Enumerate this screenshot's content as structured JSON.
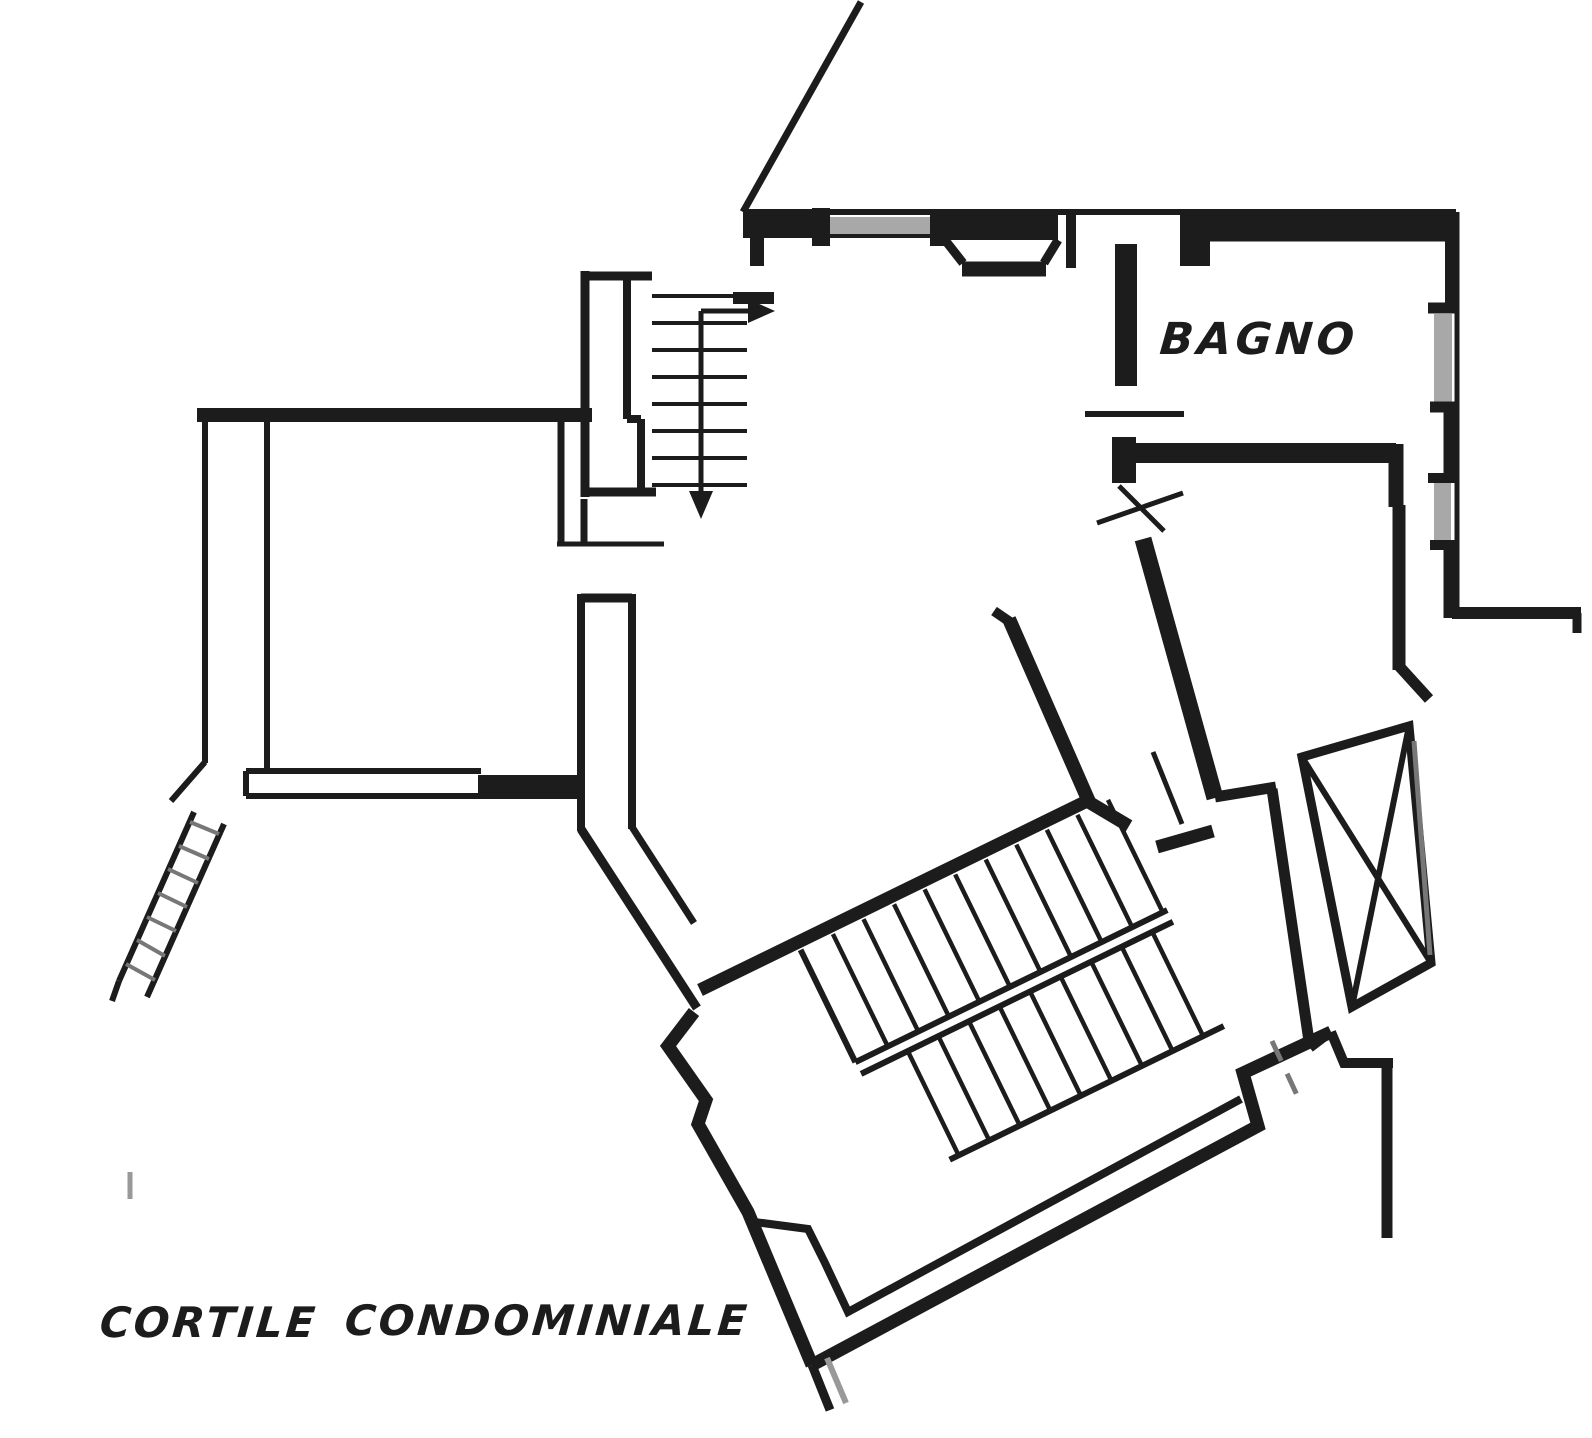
{
  "drawing": {
    "kind": "architectural floor plan, black ink on white paper"
  },
  "labels": {
    "bathroom": "BAGNO",
    "courtyard_word1": "CORTILE",
    "courtyard_word2": "CONDOMINIALE"
  },
  "colors": {
    "paper": "#ffffff",
    "ink": "#1c1c1c",
    "window_glass": "#a8a8a8",
    "hatch": "#777777",
    "faint": "#999999"
  }
}
